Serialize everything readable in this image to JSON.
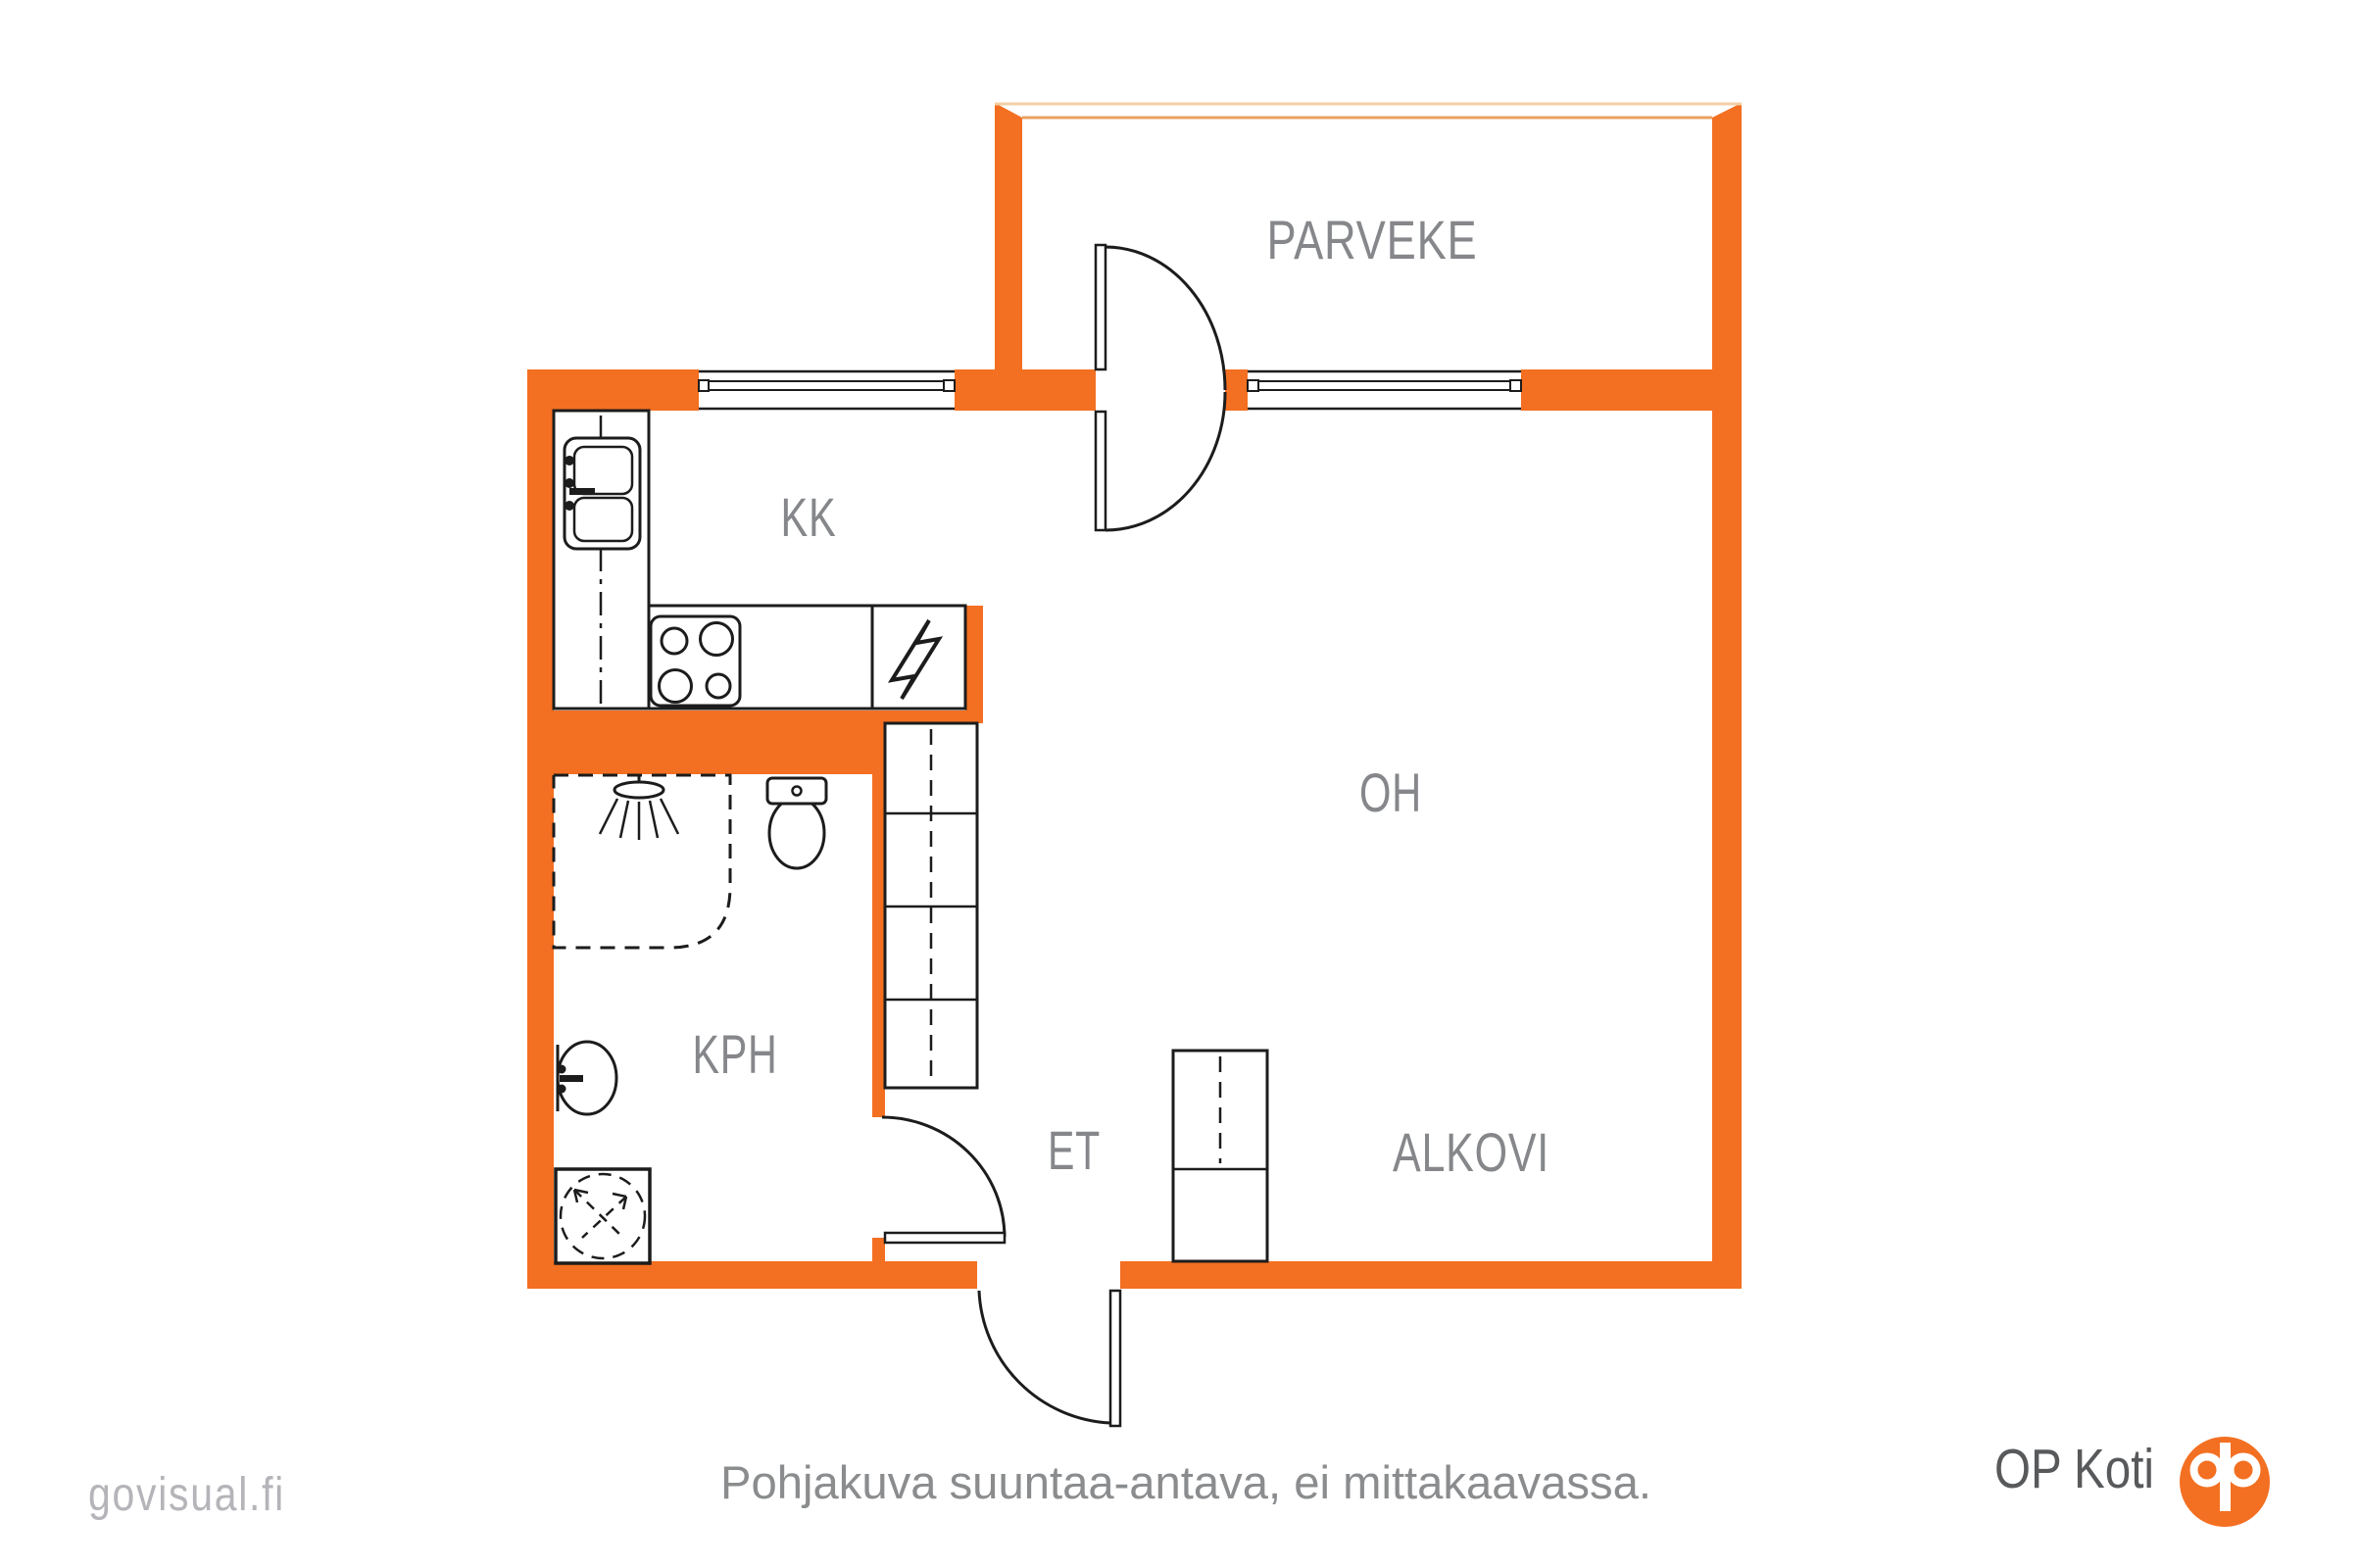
{
  "document_type": "apartment floor plan",
  "rooms": [
    {
      "id": "parveke",
      "label": "PARVEKE",
      "meaning": "balcony"
    },
    {
      "id": "kk",
      "label": "KK",
      "meaning": "kitchenette"
    },
    {
      "id": "oh",
      "label": "OH",
      "meaning": "living room"
    },
    {
      "id": "kph",
      "label": "KPH",
      "meaning": "bathroom"
    },
    {
      "id": "et",
      "label": "ET",
      "meaning": "entrance hall"
    },
    {
      "id": "alkovi",
      "label": "ALKOVI",
      "meaning": "alcove"
    }
  ],
  "fixtures": {
    "kitchen": [
      "counter",
      "double-basin-sink",
      "stove-4-burners",
      "electrical-panel"
    ],
    "bathroom": [
      "shower-corner",
      "shower-head",
      "toilet",
      "washbasin",
      "washing-machine"
    ],
    "storage": [
      "closet-by-bathroom-wall",
      "closet-alkovi"
    ],
    "doors": [
      "balcony-double-swing-door",
      "bathroom-door",
      "entrance-door"
    ],
    "windows": [
      "kitchen-window",
      "living-room-window"
    ]
  },
  "caption": "Pohjakuva suuntaa-antava, ei mittakaavassa.",
  "branding": {
    "watermark": "govisual.fi",
    "brand_text": "OP Koti",
    "logo": "op-circle-monogram"
  },
  "colors": {
    "wall_orange": "#F36F21",
    "line_black": "#1C1C1C",
    "label_gray": "#85878A",
    "caption_gray": "#8A8C8E",
    "watermark_gray": "#B4B4B9",
    "brand_gray": "#58595B",
    "balcony_edge_light": "#F3CFA4",
    "balcony_edge_tan": "#E9A15F"
  }
}
